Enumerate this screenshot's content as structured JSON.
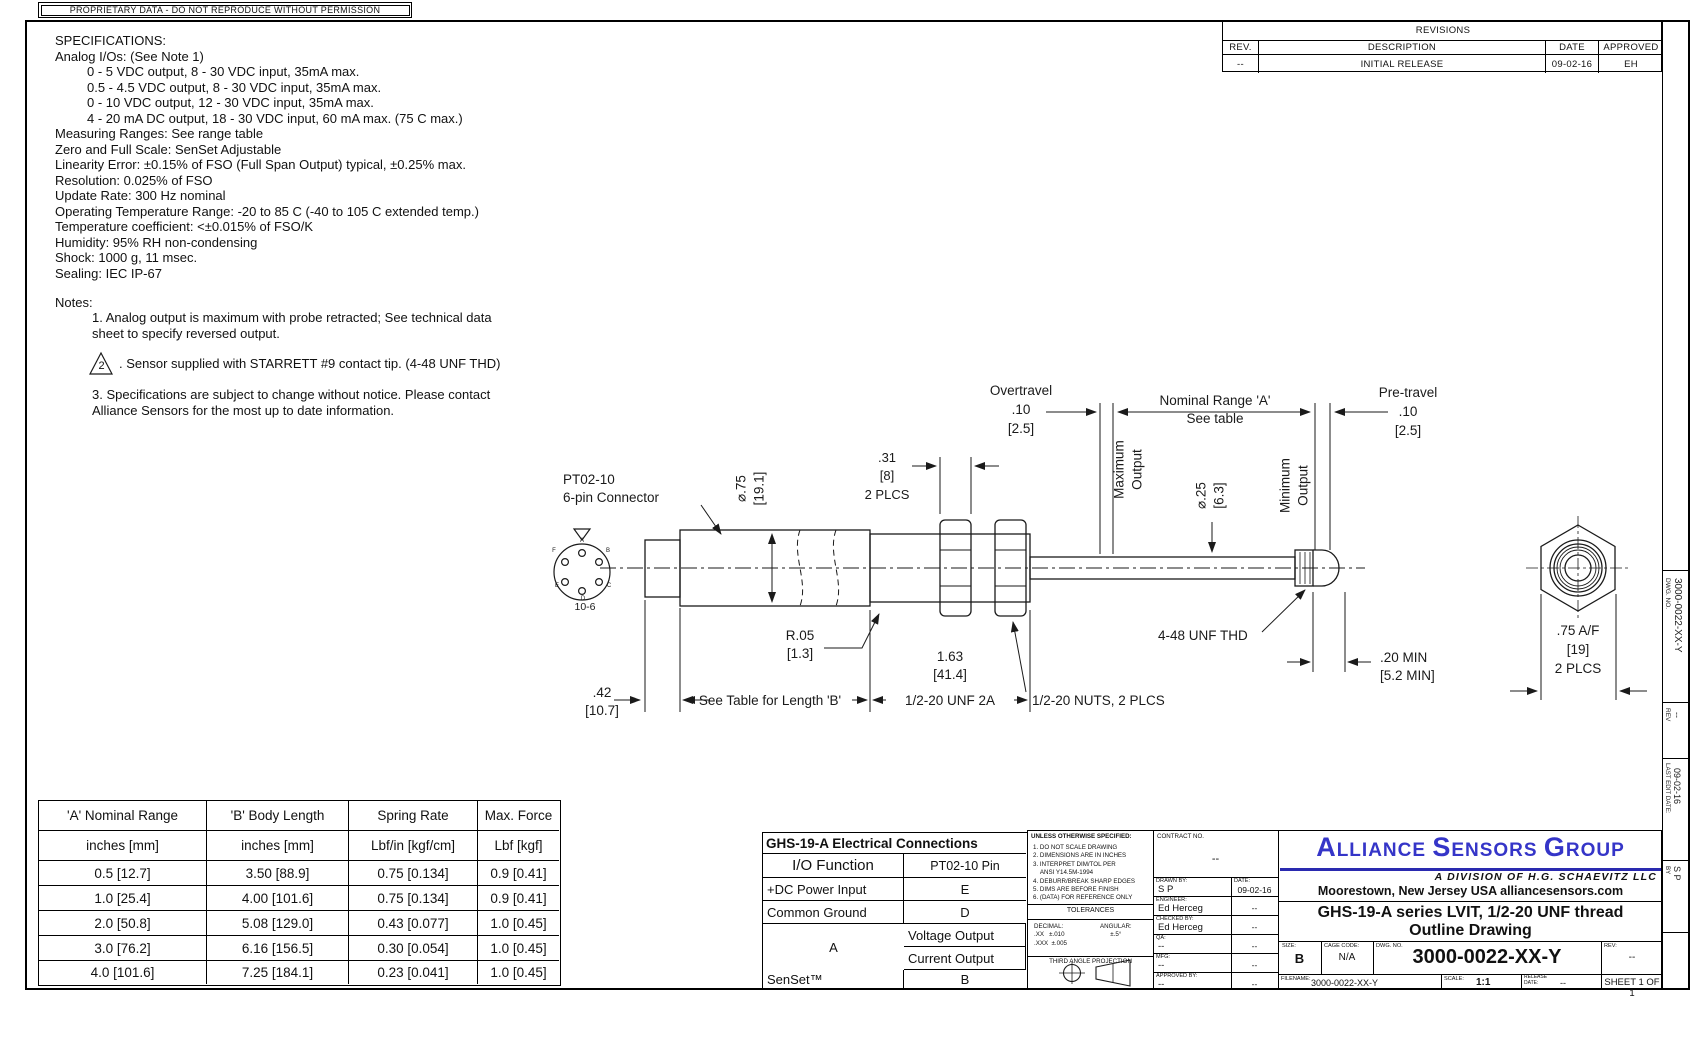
{
  "banner": "PROPRIETARY DATA - DO NOT REPRODUCE WITHOUT PERMISSION",
  "specs": {
    "title": "SPECIFICATIONS:",
    "l0": "Analog I/Os: (See Note 1)",
    "l1": "0 - 5 VDC output, 8 - 30 VDC input, 35mA max.",
    "l2": "0.5 - 4.5 VDC output, 8 - 30 VDC input, 35mA max.",
    "l3": "0 - 10 VDC output, 12 - 30 VDC input, 35mA max.",
    "l4": "4 - 20 mA DC output, 18 - 30 VDC input, 60 mA max. (75 C max.)",
    "l5": "Measuring Ranges: See range table",
    "l6": "Zero and Full Scale: SenSet Adjustable",
    "l7": "Linearity Error: ±0.15% of FSO (Full Span Output) typical, ±0.25% max.",
    "l8": "Resolution: 0.025% of FSO",
    "l9": "Update Rate: 300 Hz nominal",
    "l10": "Operating Temperature Range: -20 to 85 C (-40 to 105 C extended temp.)",
    "l11": "Temperature coefficient: <±0.015% of FSO/K",
    "l12": "Humidity: 95% RH non-condensing",
    "l13": "Shock: 1000 g, 11 msec.",
    "l14": "Sealing: IEC IP-67"
  },
  "notes": {
    "title": "Notes:",
    "n1": "1. Analog output is maximum with probe retracted; See technical data\nsheet to specify reversed output.",
    "n2_flag": "2",
    "n2": ". Sensor supplied with STARRETT #9 contact tip. (4-48 UNF THD)",
    "n3": "3. Specifications are subject to change without notice. Please contact\nAlliance Sensors for the most up to date information."
  },
  "revisions": {
    "title": "REVISIONS",
    "cols": [
      "REV.",
      "DESCRIPTION",
      "DATE",
      "APPROVED"
    ],
    "row": [
      "--",
      "INITIAL RELEASE",
      "09-02-16",
      "EH"
    ]
  },
  "drawing": {
    "connector_label": "PT02-10\n6-pin Connector",
    "connector_pins": [
      "A",
      "B",
      "C",
      "D",
      "E",
      "F"
    ],
    "connector_code": "10-6",
    "dia_body": "⌀.75\n[19.1]",
    "nut_width": ".31\n[8]\n2 PLCS",
    "overtravel": "Overtravel\n.10\n[2.5]",
    "nominal_range": "Nominal Range 'A'\nSee table",
    "pretravel": "Pre-travel\n.10\n[2.5]",
    "max_output": "Maximum\nOutput",
    "min_output": "Minimum\nOutput",
    "dia_rod": "⌀.25\n[6.3]",
    "fillet": "R.05\n[1.3]",
    "cap_len": ".42\n[10.7]",
    "body_len": "See Table for Length 'B'",
    "thread_len": "1.63\n[41.4]",
    "thread_spec": "1/2-20 UNF 2A",
    "nuts": "1/2-20 NUTS, 2 PLCS",
    "tip_thread": "4-48 UNF THD",
    "tip_min": ".20 MIN\n[5.2 MIN]",
    "hex_af": ".75 A/F\n[19]\n2 PLCS"
  },
  "range_table": {
    "headers": [
      "'A' Nominal Range",
      "'B' Body Length",
      "Spring Rate",
      "Max. Force"
    ],
    "units": [
      "inches [mm]",
      "inches [mm]",
      "Lbf/in [kgf/cm]",
      "Lbf [kgf]"
    ],
    "rows": [
      [
        "0.5 [12.7]",
        "3.50 [88.9]",
        "0.75 [0.134]",
        "0.9 [0.41]"
      ],
      [
        "1.0 [25.4]",
        "4.00 [101.6]",
        "0.75 [0.134]",
        "0.9 [0.41]"
      ],
      [
        "2.0 [50.8]",
        "5.08 [129.0]",
        "0.43 [0.077]",
        "1.0 [0.45]"
      ],
      [
        "3.0 [76.2]",
        "6.16 [156.5]",
        "0.30 [0.054]",
        "1.0 [0.45]"
      ],
      [
        "4.0 [101.6]",
        "7.25 [184.1]",
        "0.23 [0.041]",
        "1.0 [0.45]"
      ]
    ]
  },
  "elec": {
    "title": "GHS-19-A Electrical Connections",
    "col1": "I/O Function",
    "col2": "PT02-10 Pin",
    "rows": [
      [
        "+DC Power Input",
        "E"
      ],
      [
        "Common Ground",
        "D"
      ],
      [
        "Voltage Output",
        "A"
      ],
      [
        "Current Output",
        "A"
      ],
      [
        "SenSet™",
        "B"
      ]
    ]
  },
  "tb": {
    "unless": {
      "header": "UNLESS OTHERWISE SPECIFIED:",
      "items": "1. DO NOT SCALE DRAWING\n2. DIMENSIONS ARE IN INCHES\n3. INTERPRET DIM/TOL PER\n    ANSI Y14.5M-1994\n4. DEBURR/BREAK SHARP EDGES\n5. DIMS ARE BEFORE FINISH\n6. (DATA) FOR REFERENCE ONLY",
      "tolerances": "TOLERANCES",
      "decimal": "DECIMAL:\n.XX   ±.010\n.XXX  ±.005",
      "angular": "ANGULAR:\n±.5°",
      "projection": "THIRD ANGLE PROJECTION"
    },
    "contract": {
      "label": "CONTRACT NO.",
      "value": "--"
    },
    "signoff": [
      {
        "label": "DRAWN BY:",
        "name": "S P",
        "date_label": "DATE:",
        "date": "09-02-16"
      },
      {
        "label": "ENGINEER:",
        "name": "Ed Herceg",
        "date": "--"
      },
      {
        "label": "CHECKED BY:",
        "name": "Ed Herceg",
        "date": "--"
      },
      {
        "label": "QA:",
        "name": "--",
        "date": "--"
      },
      {
        "label": "MFG:",
        "name": "--",
        "date": "--"
      },
      {
        "label": "APPROVED BY:",
        "name": "--",
        "date": "--"
      }
    ],
    "company": {
      "w1b": "A",
      "w1r": "LLIANCE ",
      "w2b": "S",
      "w2r": "ENSORS ",
      "w3b": "G",
      "w3r": "ROUP",
      "division": "A  DIVISION  OF  H.G.  SCHAEVITZ  LLC",
      "address": "Moorestown, New Jersey  USA  alliancesensors.com"
    },
    "title1": "GHS-19-A series LVIT, 1/2-20 UNF thread",
    "title2": "Outline Drawing",
    "size_label": "SIZE:",
    "size": "B",
    "cage_label": "CAGE CODE:",
    "cage": "N/A",
    "dwg_label": "DWG. NO.",
    "dwg_no": "3000-0022-XX-Y",
    "rev_label": "REV:",
    "rev": "--",
    "filename_label": "FILENAME:",
    "filename": "3000-0022-XX-Y",
    "scale_label": "SCALE:",
    "scale": "1:1",
    "release_label": "RELEASE\nDATE:",
    "release": "--",
    "sheet": "SHEET 1 OF 1"
  },
  "edge": {
    "dwg_label": "DWG. NO.",
    "dwg_no": "3000-0022-XX-Y",
    "rev_label": "REV",
    "rev": "--",
    "edit_label": "LAST EDIT DATE:",
    "edit_date": "09-02-16",
    "by_label": "BY",
    "by": "S P"
  }
}
